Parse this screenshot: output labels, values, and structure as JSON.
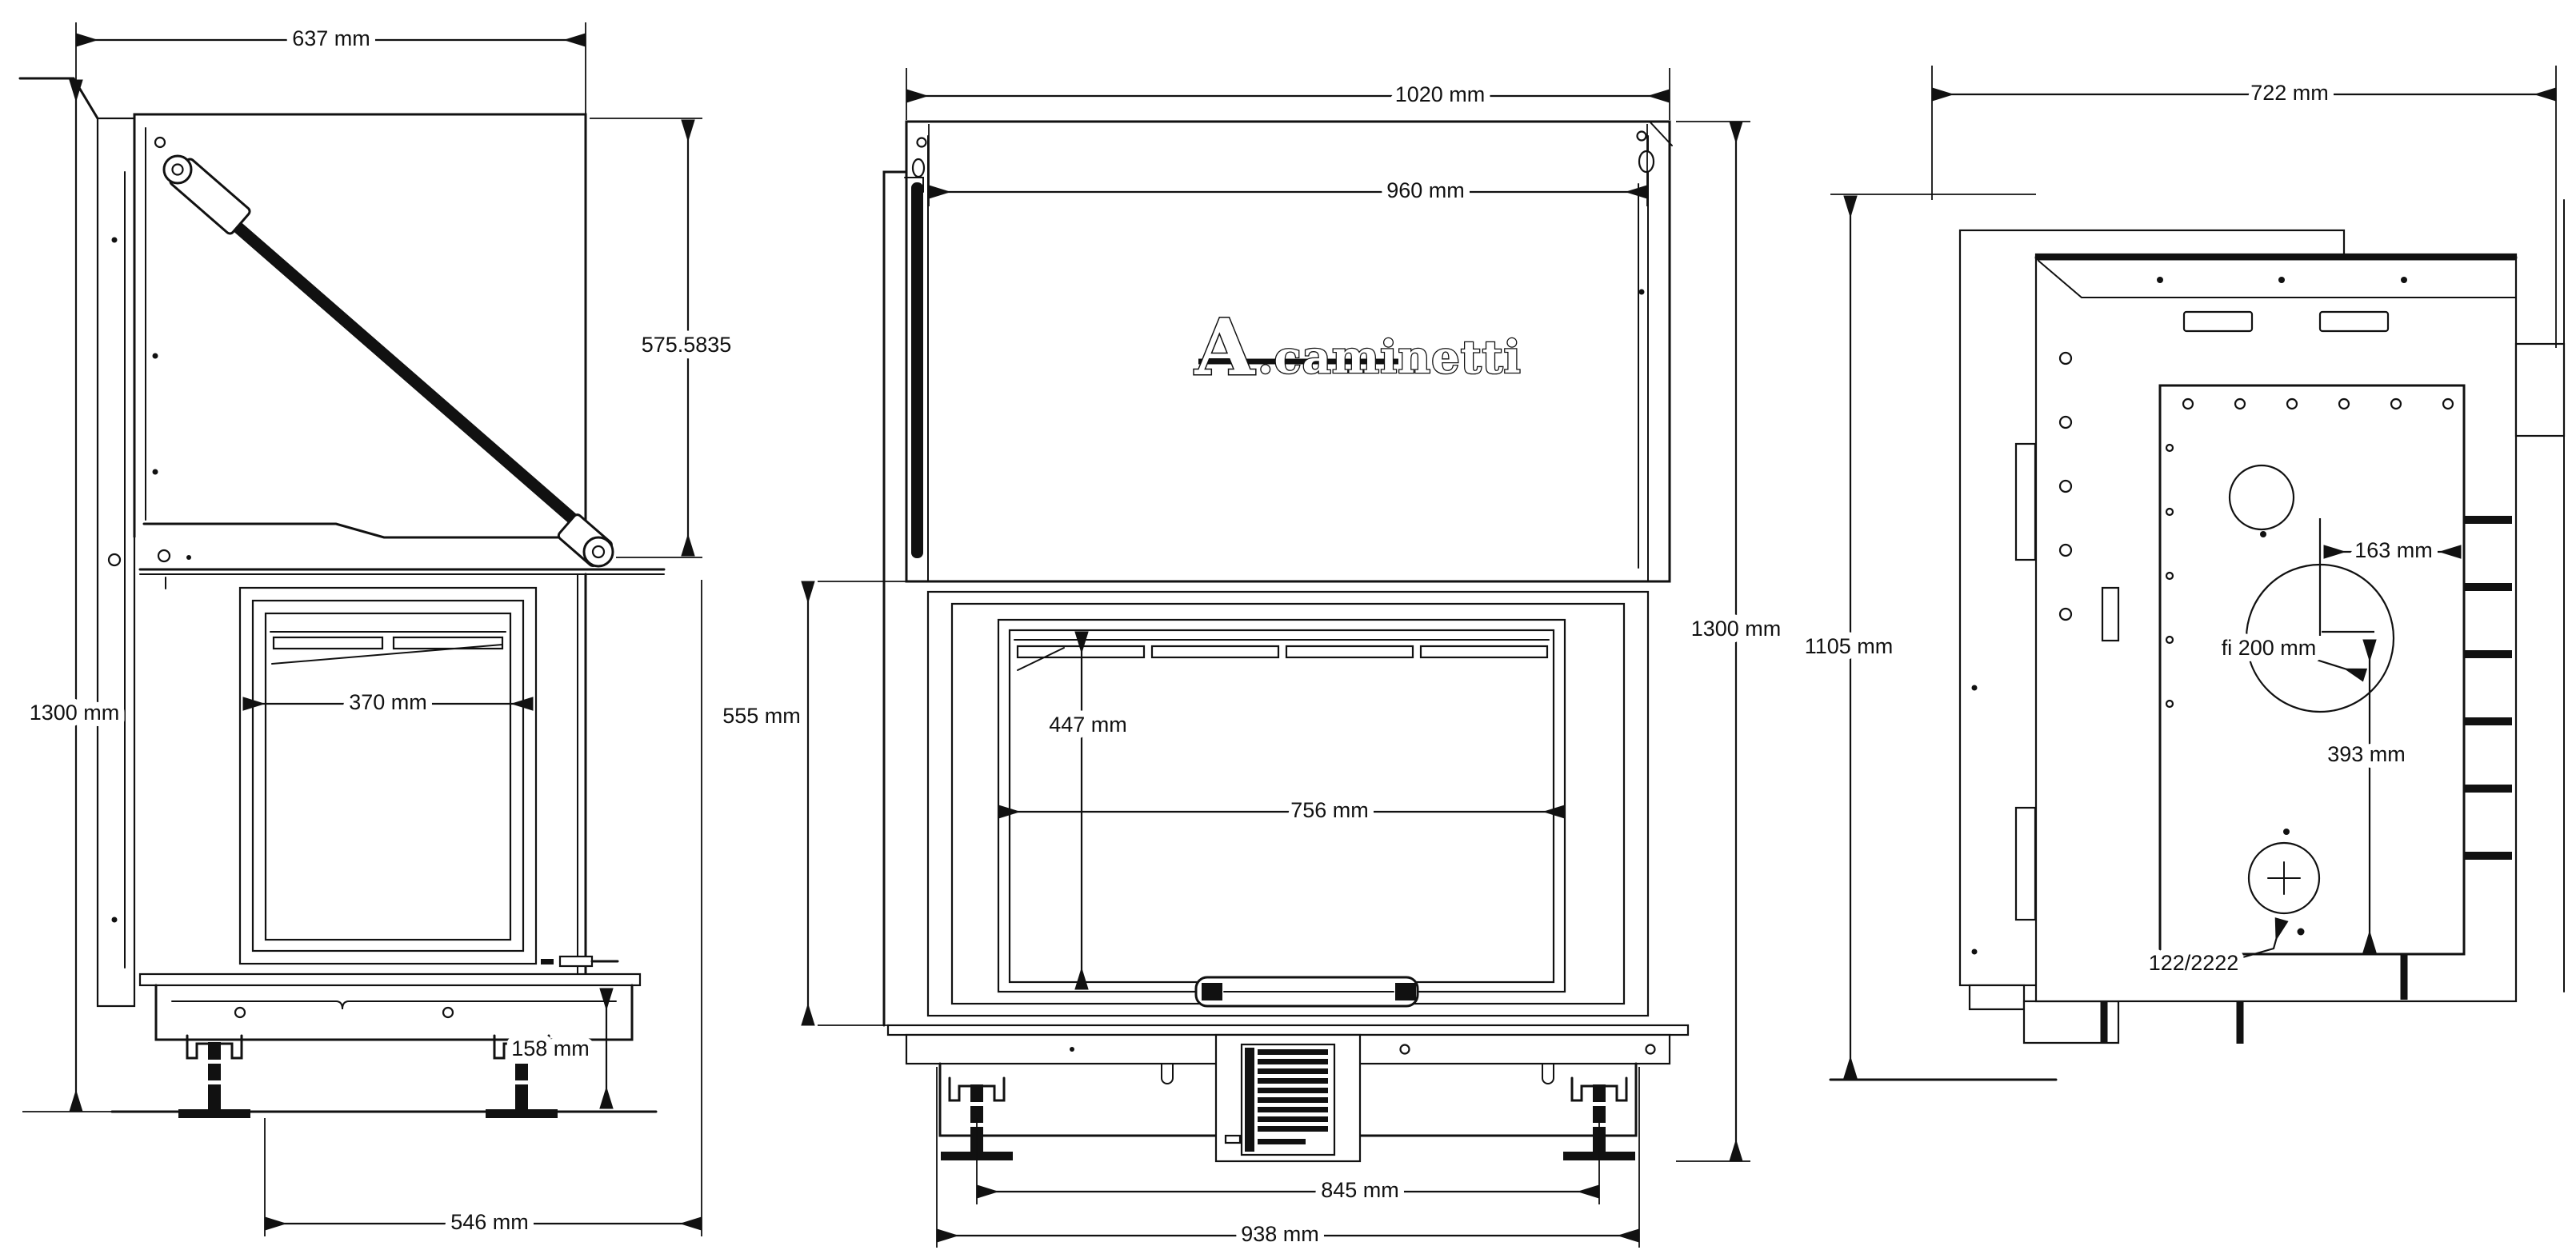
{
  "canvas": {
    "background": "#ffffff",
    "line_color": "#111111"
  },
  "brand": {
    "logo_mark": "A",
    "logo_rest": ".caminetti"
  },
  "views": {
    "side": {
      "dims": {
        "top_width": "637 mm",
        "overall_height": "1300 mm",
        "door_lift_height": "575.5835",
        "side_glass_width": "370 mm",
        "base_height": "158 mm",
        "base_depth": "546 mm"
      }
    },
    "front": {
      "dims": {
        "overall_width": "1020 mm",
        "body_width": "960 mm",
        "firebox_height": "555 mm",
        "glass_height": "447 mm",
        "glass_width": "756 mm",
        "overall_height": "1300 mm",
        "feet_spacing": "845 mm",
        "base_width": "938 mm"
      }
    },
    "rear": {
      "dims": {
        "top_depth": "722 mm",
        "body_height": "1105 mm",
        "flue_offset": "163 mm",
        "flue_diameter": "fi 200 mm",
        "flue_center_height": "393 mm",
        "intake_code": "122/2222"
      }
    }
  }
}
